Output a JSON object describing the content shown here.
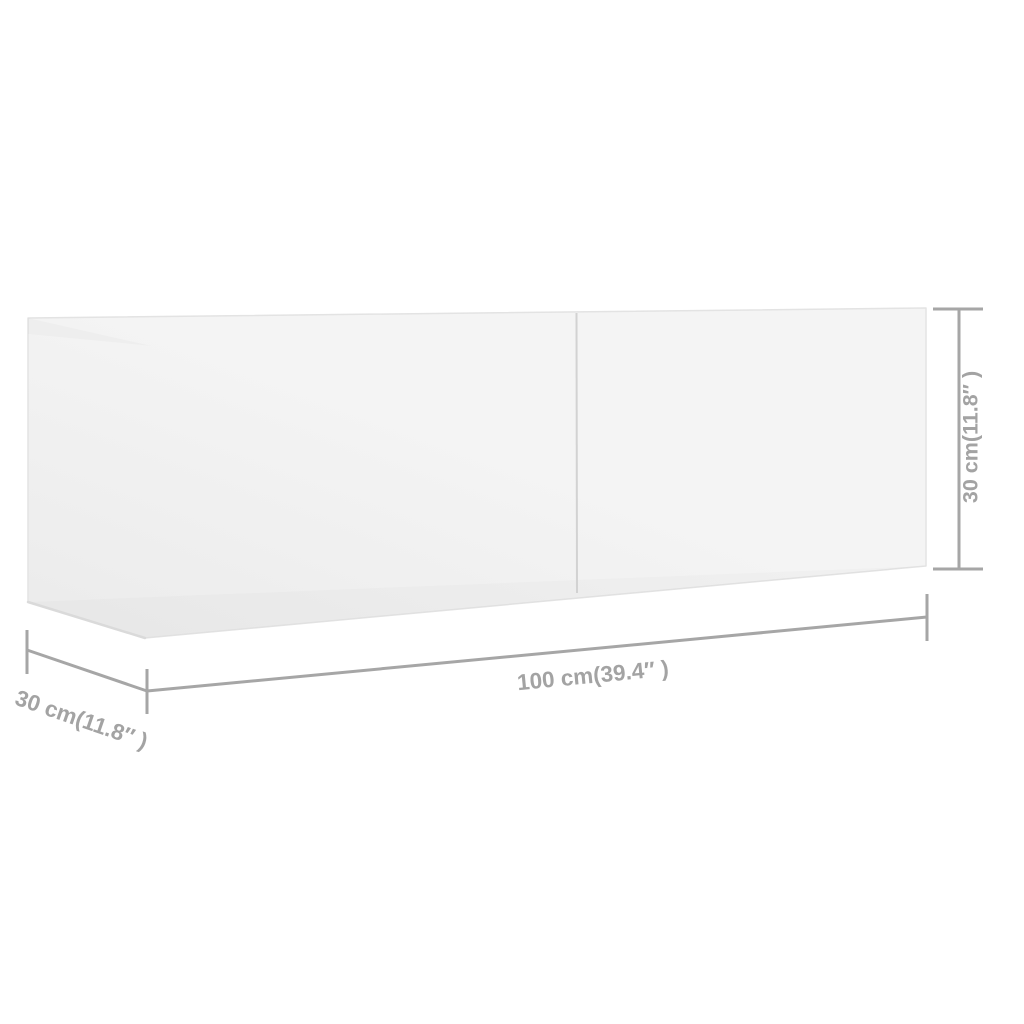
{
  "figure": {
    "kind": "product-dimension-diagram",
    "product": "tv-cabinet-two-doors",
    "dimensions": {
      "width": {
        "label": "100 cm(39.4″ )"
      },
      "depth": {
        "label": "30 cm(11.8″ )"
      },
      "height": {
        "label": "30 cm(11.8″ )"
      }
    },
    "colors": {
      "background": "#ffffff",
      "cabinet-fill-light": "#f4f4f4",
      "cabinet-fill-dark": "#ebebeb",
      "cabinet-edge": "#e3e3e3",
      "cabinet-edge-shadow": "#dadada",
      "door-divider": "#d2d2d2",
      "dimension-line": "#a6a6a6",
      "dimension-text": "#a3a3a3"
    }
  }
}
